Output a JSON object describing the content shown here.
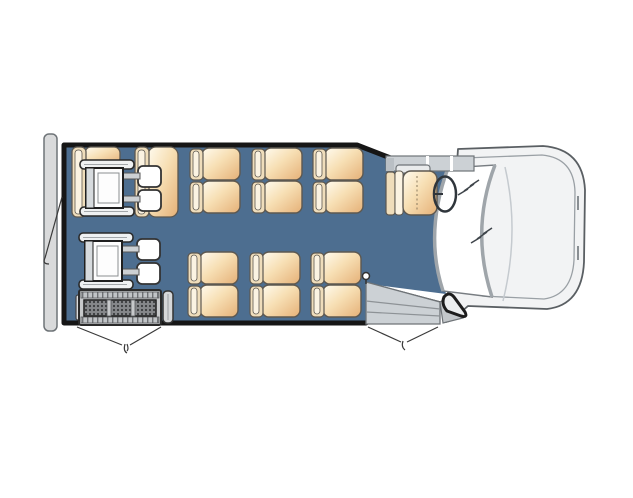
{
  "diagram": {
    "kind": "shuttle-bus-floorplan",
    "orientation": "front-of-vehicle-right",
    "passenger_double_seats": 6,
    "rear_fold_seats": 2,
    "wheelchair_positions": 2,
    "has_wheelchair_lift": true,
    "doors": [
      "rear-door",
      "lift-door",
      "front-entry-door"
    ]
  },
  "canvas": {
    "width": 633,
    "height": 498
  },
  "colors": {
    "floor": "#4d6e90",
    "wall": "#161616",
    "bumper": "#d9dadb",
    "body_fill": "#f2f3f4",
    "body_line": "#5a5f63",
    "hood_line": "#9aa0a5",
    "gray_part": "#ccd1d5",
    "gray_line": "#6f7478",
    "glass_edge": "#9fa5aa",
    "glass_outline": "#787d82",
    "bolt": "#3f454b",
    "seat_back": "#efddbb",
    "seat_back_hi": "#fbf3e2",
    "seat_outline": "#5d5850",
    "wc_outline": "#1f1f1f",
    "lift_frame": "#c7c9cb",
    "swing": "#3a3a3a"
  },
  "templates": {
    "passenger-seat-double": [
      {
        "t": "rect",
        "x": 12,
        "y": 0,
        "w": 38,
        "h": 32,
        "rx": 7,
        "f": "url(#cushGrad)",
        "s": "seat_outline",
        "sw": 1.4
      },
      {
        "t": "rect",
        "x": 12,
        "y": 33,
        "w": 38,
        "h": 32,
        "rx": 7,
        "f": "url(#cushGrad)",
        "s": "seat_outline",
        "sw": 1.4
      },
      {
        "t": "rect",
        "x": 0,
        "y": 1,
        "w": 13,
        "h": 31,
        "rx": 4,
        "f": "seat_back",
        "s": "seat_outline",
        "sw": 1.2
      },
      {
        "t": "rect",
        "x": 3,
        "y": 3,
        "w": 6,
        "h": 26,
        "rx": 3,
        "f": "seat_back_hi",
        "s": "seat_outline",
        "sw": 0.8
      },
      {
        "t": "rect",
        "x": 0,
        "y": 34,
        "w": 13,
        "h": 31,
        "rx": 4,
        "f": "seat_back",
        "s": "seat_outline",
        "sw": 1.2
      },
      {
        "t": "rect",
        "x": 3,
        "y": 36,
        "w": 6,
        "h": 26,
        "rx": 3,
        "f": "seat_back_hi",
        "s": "seat_outline",
        "sw": 0.8
      }
    ],
    "wheelchair-position": [
      {
        "t": "rect",
        "x": 60,
        "y": 6,
        "w": 23,
        "h": 21,
        "rx": 5,
        "f": "#ffffff",
        "s": "#333333",
        "sw": 1.8
      },
      {
        "t": "rect",
        "x": 60,
        "y": 30,
        "w": 23,
        "h": 21,
        "rx": 5,
        "f": "#ffffff",
        "s": "#333333",
        "sw": 1.8
      },
      {
        "t": "rect",
        "x": 45,
        "y": 13,
        "w": 17,
        "h": 6,
        "f": "#ccd0d3",
        "s": "#555555",
        "sw": 1
      },
      {
        "t": "rect",
        "x": 45,
        "y": 36,
        "w": 17,
        "h": 6,
        "f": "#ccd0d3",
        "s": "#555555",
        "sw": 1
      },
      {
        "t": "rect",
        "x": 2,
        "y": 0,
        "w": 54,
        "h": 9,
        "rx": 4,
        "f": "#eff1f2",
        "s": "#2a2a2a",
        "sw": 1.6
      },
      {
        "t": "line",
        "x1": 6,
        "y1": 4.5,
        "x2": 50,
        "y2": 4.5,
        "s": "#a3a7aa",
        "sw": 1
      },
      {
        "t": "rect",
        "x": 2,
        "y": 47,
        "w": 54,
        "h": 9,
        "rx": 4,
        "f": "#eff1f2",
        "s": "#2a2a2a",
        "sw": 1.6
      },
      {
        "t": "line",
        "x1": 6,
        "y1": 51.5,
        "x2": 50,
        "y2": 51.5,
        "s": "#a3a7aa",
        "sw": 1
      },
      {
        "t": "rect",
        "x": 8,
        "y": 8,
        "w": 37,
        "h": 40,
        "f": "#fdfdfd",
        "s": "wc_outline",
        "sw": 2
      },
      {
        "t": "rect",
        "x": 8,
        "y": 8,
        "w": 8,
        "h": 40,
        "f": "#d7dbde",
        "s": "wc_outline",
        "sw": 1
      },
      {
        "t": "rect",
        "x": 20,
        "y": 13,
        "w": 21,
        "h": 30,
        "f": "none",
        "s": "#8a8e91",
        "sw": 1
      }
    ]
  },
  "scene": [
    {
      "name": "rear-bumper",
      "interactable": false,
      "shapes": [
        {
          "t": "rect",
          "x": 44,
          "y": 134,
          "w": 13,
          "h": 197,
          "rx": 5,
          "f": "bumper",
          "s": "gray_line",
          "sw": 1.5
        }
      ]
    },
    {
      "name": "vehicle-front-cab",
      "interactable": false,
      "shapes": [
        {
          "t": "path",
          "d": "M458,149 L543,146 Q583,149 585,190 L584,262 Q582,305 547,309 L468,306 L452,320 L446,322 Z",
          "f": "body_fill",
          "s": "body_line",
          "sw": 1.8,
          "join": "round"
        },
        {
          "t": "path",
          "d": "M464,158 L542,155 Q574,158 575,192 L574,260 Q572,295 544,299 L482,296",
          "f": "none",
          "s": "hood_line",
          "sw": 1.3
        },
        {
          "t": "path",
          "d": "M505,167 Q520,232 503,301",
          "f": "none",
          "s": "#c5cacf",
          "sw": 1.5
        },
        {
          "t": "line",
          "x1": 578,
          "y1": 196,
          "x2": 578,
          "y2": 210,
          "s": "#8a8f93",
          "sw": 2
        },
        {
          "t": "line",
          "x1": 578,
          "y1": 246,
          "x2": 578,
          "y2": 260,
          "s": "#8a8f93",
          "sw": 2
        }
      ]
    },
    {
      "name": "bus-floor",
      "interactable": false,
      "shapes": [
        {
          "t": "path",
          "d": "M62,146 L358,146 L400,163 L454,172 Q430,235 446,294 L368,284 L366,284 L366,321 L62,321 Z",
          "f": "floor"
        }
      ]
    },
    {
      "name": "bus-walls",
      "interactable": false,
      "shapes": [
        {
          "t": "path",
          "d": "M366,323 L64,323 L64,145 L357,145 L401,162",
          "f": "none",
          "s": "wall",
          "sw": 5,
          "join": "round",
          "cap": "round"
        },
        {
          "t": "path",
          "d": "M369,285 L441,304",
          "f": "none",
          "s": "wall",
          "sw": 5,
          "cap": "round"
        }
      ]
    },
    {
      "name": "windshield",
      "interactable": false,
      "shapes": [
        {
          "t": "path",
          "d": "M448,168 Q424,233 443,291 L492,297 Q470,230 495,165 Z",
          "f": "#ffffff",
          "s": "glass_outline",
          "sw": 1.4
        },
        {
          "t": "path",
          "d": "M448,168 Q424,233 443,291",
          "f": "none",
          "s": "glass_edge",
          "sw": 3.5
        },
        {
          "t": "path",
          "d": "M495,165 Q470,230 492,297",
          "f": "none",
          "s": "glass_edge",
          "sw": 3.5
        }
      ]
    },
    {
      "name": "windshield-reflection-icon",
      "interactable": false,
      "shapes": [
        {
          "t": "polyline",
          "pts": "458,195 468,189 464,191 474,184 470,186 479,180",
          "f": "none",
          "s": "bolt",
          "sw": 1.5
        },
        {
          "t": "polyline",
          "pts": "471,243 481,237 477,239 487,232 483,234 492,228",
          "f": "none",
          "s": "bolt",
          "sw": 1.5
        }
      ]
    },
    {
      "name": "cab-sill-panel",
      "interactable": false,
      "shapes": [
        {
          "t": "rect",
          "x": 386,
          "y": 156,
          "w": 88,
          "h": 15,
          "f": "gray_part",
          "s": "gray_line",
          "sw": 1.2
        },
        {
          "t": "rect",
          "x": 426,
          "y": 156,
          "w": 3,
          "h": 15,
          "f": "#ffffff"
        },
        {
          "t": "rect",
          "x": 450,
          "y": 156,
          "w": 3,
          "h": 15,
          "f": "#ffffff"
        },
        {
          "t": "rect",
          "x": 386,
          "y": 158,
          "w": 8,
          "h": 13,
          "f": "#b9bfc4"
        }
      ]
    },
    {
      "name": "entry-steps",
      "interactable": false,
      "shapes": [
        {
          "t": "path",
          "d": "M366,282 L440,302 L440,324 L366,324 Z",
          "f": "gray_part",
          "s": "gray_line",
          "sw": 1.3
        },
        {
          "t": "path",
          "d": "M366,301 L440,309",
          "f": "none",
          "s": "#8d9296",
          "sw": 1.2
        },
        {
          "t": "path",
          "d": "M366,312 L440,316",
          "f": "none",
          "s": "#8d9296",
          "sw": 1.2
        },
        {
          "t": "path",
          "d": "M440,302 L452,295 L463,318 L443,323 Z",
          "f": "#c3c7ca",
          "s": "gray_line",
          "sw": 1.2
        }
      ]
    },
    {
      "name": "front-wheel-arch",
      "interactable": false,
      "shapes": [
        {
          "t": "path",
          "d": "M444,297 Q449,291 454,297 L465,312 Q468,318 461,316 L447,311 Q441,304 444,297 Z",
          "f": "#eceeef",
          "s": "#1d1d1d",
          "sw": 3,
          "join": "round"
        }
      ]
    },
    {
      "name": "entry-stanchion",
      "interactable": false,
      "shapes": [
        {
          "t": "line",
          "x1": 366,
          "y1": 284,
          "x2": 366,
          "y2": 277,
          "s": "#333333",
          "sw": 1.5
        },
        {
          "t": "circle",
          "cx": 366,
          "cy": 276,
          "r": 3.5,
          "f": "#ffffff",
          "s": "#333333",
          "sw": 1.5
        }
      ]
    },
    {
      "name": "fold-seat-rear-left",
      "interactable": false,
      "shapes": [
        {
          "t": "rect",
          "x": 85,
          "y": 147,
          "w": 35,
          "h": 17,
          "rx": 6,
          "f": "url(#cushGrad)",
          "s": "seat_outline",
          "sw": 1.3
        },
        {
          "t": "rect",
          "x": 72,
          "y": 147,
          "w": 14,
          "h": 70,
          "rx": 5,
          "f": "seat_back",
          "s": "seat_outline",
          "sw": 1.3
        },
        {
          "t": "rect",
          "x": 75,
          "y": 150,
          "w": 7,
          "h": 64,
          "rx": 3,
          "f": "seat_back_hi",
          "s": "seat_outline",
          "sw": 0.8
        }
      ]
    },
    {
      "name": "fold-seat-rear-right",
      "interactable": false,
      "shapes": [
        {
          "t": "rect",
          "x": 148,
          "y": 147,
          "w": 30,
          "h": 70,
          "rx": 8,
          "f": "url(#cushGrad)",
          "s": "seat_outline",
          "sw": 1.3
        },
        {
          "t": "rect",
          "x": 135,
          "y": 147,
          "w": 14,
          "h": 70,
          "rx": 5,
          "f": "seat_back",
          "s": "seat_outline",
          "sw": 1.3
        },
        {
          "t": "rect",
          "x": 138,
          "y": 150,
          "w": 7,
          "h": 64,
          "rx": 3,
          "f": "seat_back_hi",
          "s": "seat_outline",
          "sw": 0.8
        }
      ]
    },
    {
      "name": "wheelchair-position-1",
      "interactable": false,
      "template": "wheelchair-position",
      "x": 78,
      "y": 160
    },
    {
      "name": "passenger-seat-double",
      "interactable": false,
      "template": "passenger-seat-double",
      "x": 190,
      "y": 148
    },
    {
      "name": "passenger-seat-double",
      "interactable": false,
      "template": "passenger-seat-double",
      "x": 252,
      "y": 148
    },
    {
      "name": "passenger-seat-double",
      "interactable": false,
      "template": "passenger-seat-double",
      "x": 313,
      "y": 148
    },
    {
      "name": "passenger-seat-double",
      "interactable": false,
      "template": "passenger-seat-double",
      "x": 188,
      "y": 252
    },
    {
      "name": "passenger-seat-double",
      "interactable": false,
      "template": "passenger-seat-double",
      "x": 250,
      "y": 252
    },
    {
      "name": "passenger-seat-double",
      "interactable": false,
      "template": "passenger-seat-double",
      "x": 311,
      "y": 252
    },
    {
      "name": "driver-seat",
      "interactable": false,
      "shapes": [
        {
          "t": "rect",
          "x": 396,
          "y": 165,
          "w": 34,
          "h": 8,
          "rx": 3,
          "f": "#e9ebec",
          "s": "gray_line",
          "sw": 1.2
        },
        {
          "t": "rect",
          "x": 386,
          "y": 172,
          "w": 9,
          "h": 43,
          "rx": 3,
          "f": "seat_back",
          "s": "seat_outline",
          "sw": 1.2
        },
        {
          "t": "rect",
          "x": 395,
          "y": 171,
          "w": 8,
          "h": 44,
          "rx": 3,
          "f": "seat_back_hi",
          "s": "seat_outline",
          "sw": 1
        },
        {
          "t": "rect",
          "x": 403,
          "y": 171,
          "w": 34,
          "h": 44,
          "rx": 8,
          "f": "url(#cushGrad)",
          "s": "seat_outline",
          "sw": 1.4
        },
        {
          "t": "line",
          "x1": 417,
          "y1": 176,
          "x2": 417,
          "y2": 211,
          "s": "#8a7a5f",
          "sw": 1,
          "dash": "2,2.5"
        }
      ]
    },
    {
      "name": "steering-wheel-icon",
      "interactable": false,
      "shapes": [
        {
          "t": "ellipse",
          "cx": 445,
          "cy": 194,
          "rx": 11,
          "ry": 17.5,
          "f": "none",
          "s": "#2f353b",
          "sw": 2.5
        },
        {
          "t": "line",
          "x1": 433,
          "y1": 194,
          "x2": 443,
          "y2": 194,
          "s": "#2f353b",
          "sw": 2
        }
      ]
    },
    {
      "name": "wheelchair-position-2",
      "interactable": false,
      "template": "wheelchair-position",
      "x": 77,
      "y": 233
    },
    {
      "name": "wheelchair-lift",
      "interactable": false,
      "shapes": [
        {
          "t": "rect",
          "x": 76,
          "y": 295,
          "w": 5,
          "h": 25,
          "rx": 2,
          "f": "#dadcde",
          "s": "#444444",
          "sw": 1.2
        },
        {
          "t": "rect",
          "x": 79,
          "y": 290,
          "w": 82,
          "h": 35,
          "rx": 2,
          "f": "lift_frame",
          "s": "#2a2a2a",
          "sw": 2
        },
        {
          "t": "rect",
          "x": 81,
          "y": 292,
          "w": 78,
          "h": 6,
          "f": "url(#railTicks)",
          "s": "#55585b",
          "sw": 0.8
        },
        {
          "t": "rect",
          "x": 81,
          "y": 317,
          "w": 78,
          "h": 6,
          "f": "url(#railTicks)",
          "s": "#55585b",
          "sw": 0.8
        },
        {
          "t": "rect",
          "x": 84,
          "y": 300,
          "w": 72,
          "h": 16,
          "f": "url(#liftDots)",
          "s": "wc_outline",
          "sw": 1.5
        },
        {
          "t": "rect",
          "x": 107,
          "y": 300,
          "w": 4,
          "h": 16,
          "f": "lift_frame",
          "s": "#55585b",
          "sw": 0.8
        },
        {
          "t": "rect",
          "x": 131,
          "y": 300,
          "w": 4,
          "h": 16,
          "f": "lift_frame",
          "s": "#55585b",
          "sw": 0.8
        },
        {
          "t": "rect",
          "x": 163,
          "y": 291,
          "w": 10,
          "h": 32,
          "rx": 4,
          "f": "#d6d8da",
          "s": "#333333",
          "sw": 1.5
        },
        {
          "t": "line",
          "x1": 168,
          "y1": 294,
          "x2": 168,
          "y2": 320,
          "s": "#9a9ea1",
          "sw": 1
        }
      ]
    },
    {
      "name": "rear-door-swing-line",
      "interactable": false,
      "shapes": [
        {
          "t": "path",
          "d": "M62,197 Q54,226 45,258",
          "f": "none",
          "s": "swing",
          "sw": 1.2
        },
        {
          "t": "path",
          "d": "M45,258 q-3,6 4,6",
          "f": "none",
          "s": "swing",
          "sw": 1.2
        }
      ]
    },
    {
      "name": "lift-door-swing-line",
      "interactable": false,
      "shapes": [
        {
          "t": "path",
          "d": "M77,327 L122,345",
          "f": "none",
          "s": "swing",
          "sw": 1.2
        },
        {
          "t": "path",
          "d": "M161,327 L130,345",
          "f": "none",
          "s": "swing",
          "sw": 1.2
        },
        {
          "t": "path",
          "d": "M125,344 q-2,7 2,9",
          "f": "none",
          "s": "swing",
          "sw": 1.2
        },
        {
          "t": "path",
          "d": "M127,344 q2,5 0,7",
          "f": "none",
          "s": "swing",
          "sw": 1.2
        }
      ]
    },
    {
      "name": "entry-door-swing-line",
      "interactable": false,
      "shapes": [
        {
          "t": "path",
          "d": "M368,327 L401,342",
          "f": "none",
          "s": "swing",
          "sw": 1.2
        },
        {
          "t": "path",
          "d": "M438,327 L407,342",
          "f": "none",
          "s": "swing",
          "sw": 1.2
        },
        {
          "t": "path",
          "d": "M403,341 q-2,6 2,9",
          "f": "none",
          "s": "swing",
          "sw": 1.2
        }
      ]
    }
  ]
}
